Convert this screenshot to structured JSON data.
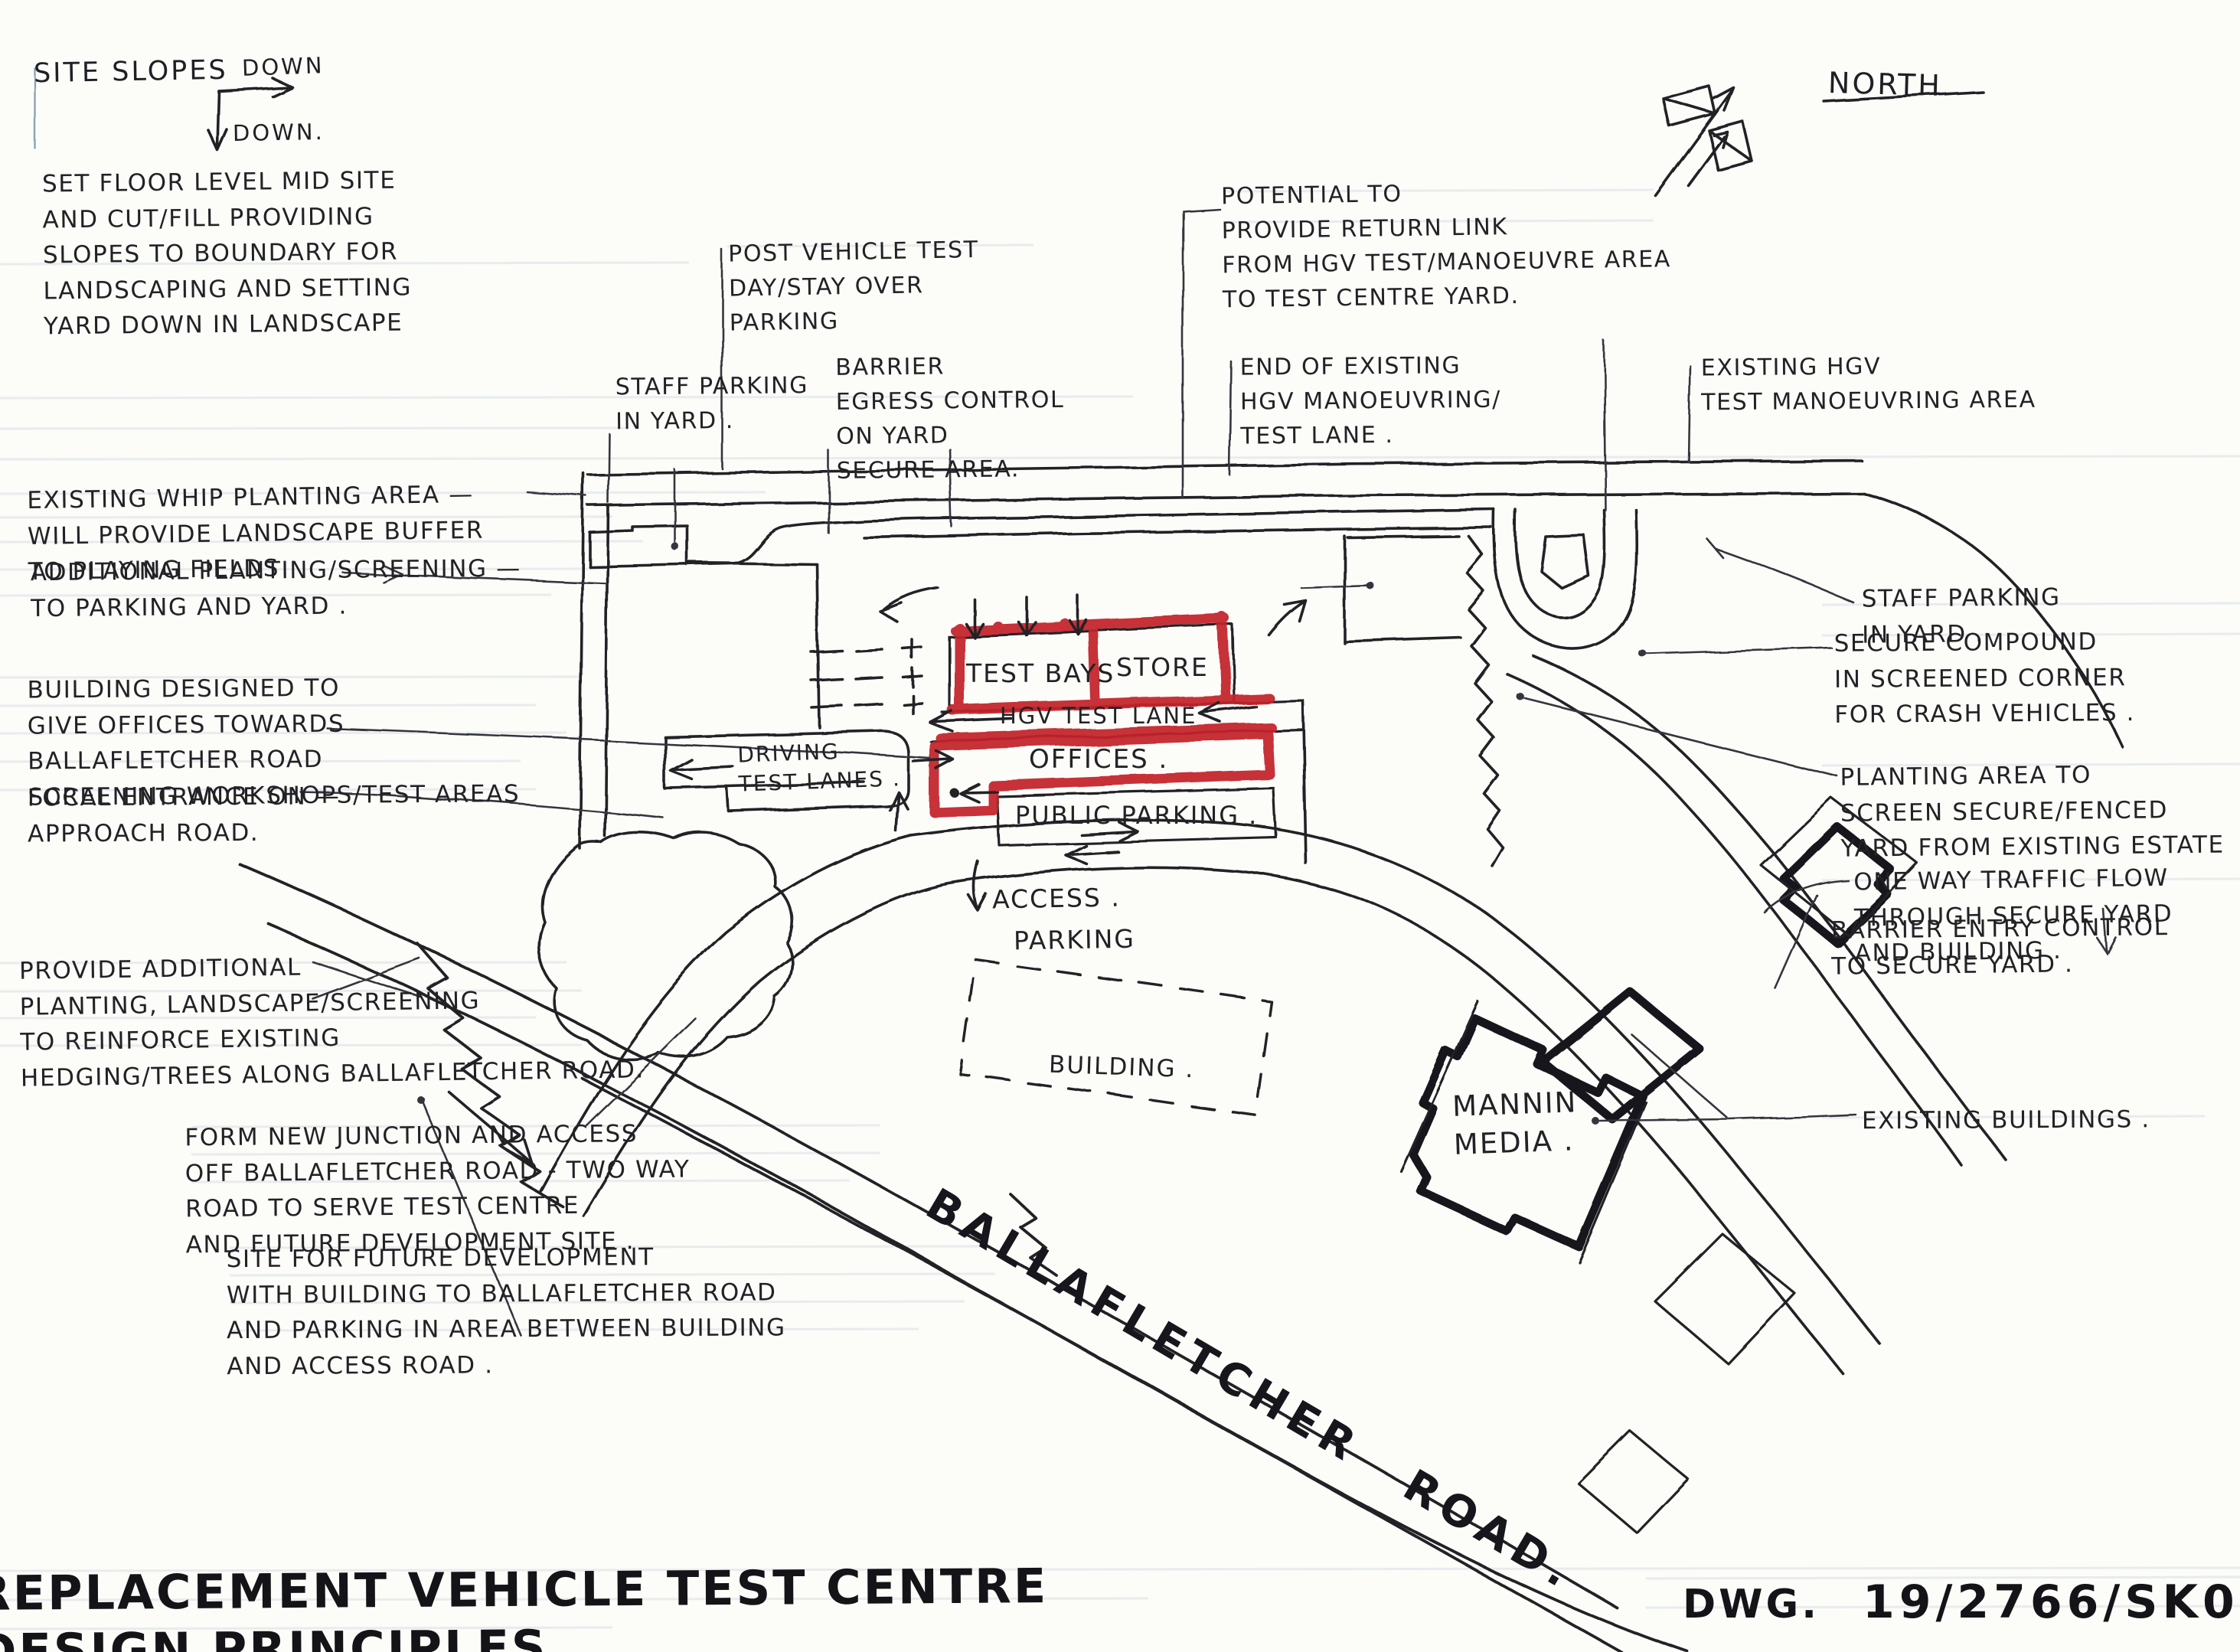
{
  "drawing": {
    "title_line1": "REPLACEMENT VEHICLE TEST CENTRE",
    "title_line2": "DESIGN PRINCIPLES",
    "dwg_label": "DWG.",
    "dwg_number": "19/2766/SK01",
    "north_label": "NORTH",
    "colors": {
      "ink": "#232327",
      "red": "#c4202a",
      "paper": "#fcfcf9"
    }
  },
  "slope_note": {
    "heading": "SITE SLOPES",
    "arrow_right_label": "DOWN",
    "arrow_down_label": "DOWN."
  },
  "annotations": [
    {
      "id": "set-floor-level",
      "text": "SET FLOOR LEVEL MID SITE\nAND CUT/FILL PROVIDING\nSLOPES TO BOUNDARY FOR\nLANDSCAPING AND SETTING\nYARD DOWN IN LANDSCAPE"
    },
    {
      "id": "existing-whip-planting",
      "text": "EXISTING WHIP PLANTING AREA —\nWILL PROVIDE LANDSCAPE BUFFER\nTO PLAYING FIELDS"
    },
    {
      "id": "additional-planting",
      "text": "ADDITIONAL PLANTING/SCREENING —\nTO PARKING AND YARD ."
    },
    {
      "id": "building-designed",
      "text": "BUILDING DESIGNED TO\nGIVE OFFICES TOWARDS\nBALLAFLETCHER ROAD\nSCREENING WORKSHOPS/TEST AREAS"
    },
    {
      "id": "focal-entrance",
      "text": "FOCAL ENTRANCE ON —\nAPPROACH ROAD."
    },
    {
      "id": "provide-additional-planting",
      "text": "PROVIDE ADDITIONAL\nPLANTING, LANDSCAPE/SCREENING\nTO REINFORCE EXISTING\nHEDGING/TREES ALONG BALLAFLETCHER ROAD."
    },
    {
      "id": "form-new-junction",
      "text": "FORM NEW JUNCTION AND ACCESS\nOFF BALLAFLETCHER ROAD - TWO WAY\nROAD TO SERVE TEST CENTRE\nAND FUTURE DEVELOPMENT SITE ."
    },
    {
      "id": "site-for-future-development",
      "text": "SITE FOR FUTURE DEVELOPMENT\nWITH BUILDING TO BALLAFLETCHER ROAD\nAND PARKING IN AREA BETWEEN BUILDING\nAND ACCESS ROAD ."
    },
    {
      "id": "post-vehicle-test-parking",
      "text": "POST VEHICLE TEST\nDAY/STAY OVER\nPARKING"
    },
    {
      "id": "staff-parking-in-yard-left",
      "text": "STAFF PARKING\nIN YARD ."
    },
    {
      "id": "barrier-egress-control",
      "text": "BARRIER\nEGRESS CONTROL\nON YARD\nSECURE AREA."
    },
    {
      "id": "potential-return-link",
      "text": "POTENTIAL TO\nPROVIDE RETURN LINK\nFROM HGV TEST/MANOEUVRE AREA\nTO TEST CENTRE YARD."
    },
    {
      "id": "end-of-existing-test-lane",
      "text": "END OF EXISTING\nHGV MANOEUVRING/\nTEST LANE ."
    },
    {
      "id": "existing-hgv-manoeuvring-area",
      "text": "EXISTING HGV\nTEST MANOEUVRING AREA"
    },
    {
      "id": "staff-parking-in-yard-right",
      "text": "STAFF PARKING\nIN YARD ."
    },
    {
      "id": "secure-compound",
      "text": "SECURE COMPOUND\nIN SCREENED CORNER\nFOR CRASH VEHICLES ."
    },
    {
      "id": "planting-area-screen",
      "text": "PLANTING AREA TO\nSCREEN SECURE/FENCED\nYARD FROM EXISTING ESTATE"
    },
    {
      "id": "one-way-traffic-flow",
      "text": "ONE WAY TRAFFIC FLOW\nTHROUGH SECURE YARD\nAND BUILDING ."
    },
    {
      "id": "barrier-entry-control",
      "text": "BARRIER ENTRY CONTROL\nTO SECURE YARD ."
    },
    {
      "id": "existing-buildings",
      "text": "EXISTING BUILDINGS ."
    }
  ],
  "plan_labels": [
    {
      "id": "test-bays",
      "text": "TEST BAYS"
    },
    {
      "id": "store",
      "text": "STORE"
    },
    {
      "id": "hgv-test-lane",
      "text": "HGV TEST LANE"
    },
    {
      "id": "offices",
      "text": "OFFICES ."
    },
    {
      "id": "public-parking",
      "text": "PUBLIC PARKING ."
    },
    {
      "id": "driving-test-lanes",
      "text": "DRIVING\nTEST LANES ."
    },
    {
      "id": "access",
      "text": "ACCESS ."
    },
    {
      "id": "parking",
      "text": "PARKING"
    },
    {
      "id": "building",
      "text": "BUILDING ."
    },
    {
      "id": "mannin-media",
      "text": "MANNIN\nMEDIA ."
    },
    {
      "id": "ballafletcher-road",
      "text": "BALLAFLETCHER  ROAD."
    }
  ]
}
